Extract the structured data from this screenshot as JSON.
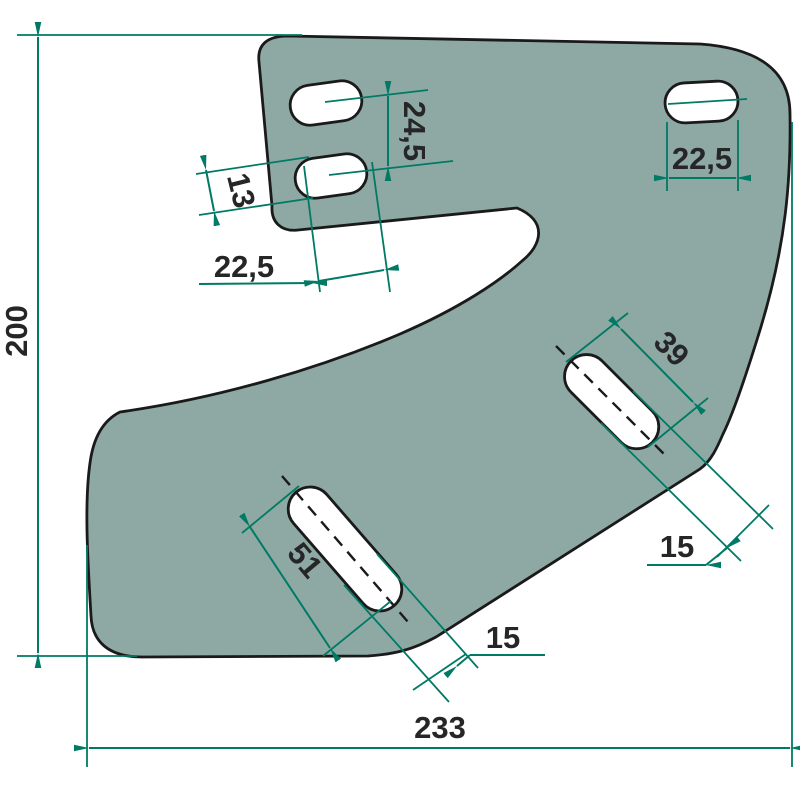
{
  "drawing": {
    "type": "technical-dimension-drawing",
    "colors": {
      "plate_fill": "#8EA9A4",
      "part_outline": "#1A1A1A",
      "dimension_lines": "#007A64",
      "label_text": "#262626",
      "background": "#FFFFFF"
    },
    "labels": {
      "overall_height": "200",
      "overall_width": "233",
      "top_right_slot_length": "22,5",
      "left_slots_spacing": "24,5",
      "left_slot_width": "13",
      "left_slot_length": "22,5",
      "upper_diag_slot_length": "39",
      "upper_diag_slot_width": "15",
      "lower_diag_slot_length": "51",
      "lower_diag_slot_width": "15"
    }
  }
}
